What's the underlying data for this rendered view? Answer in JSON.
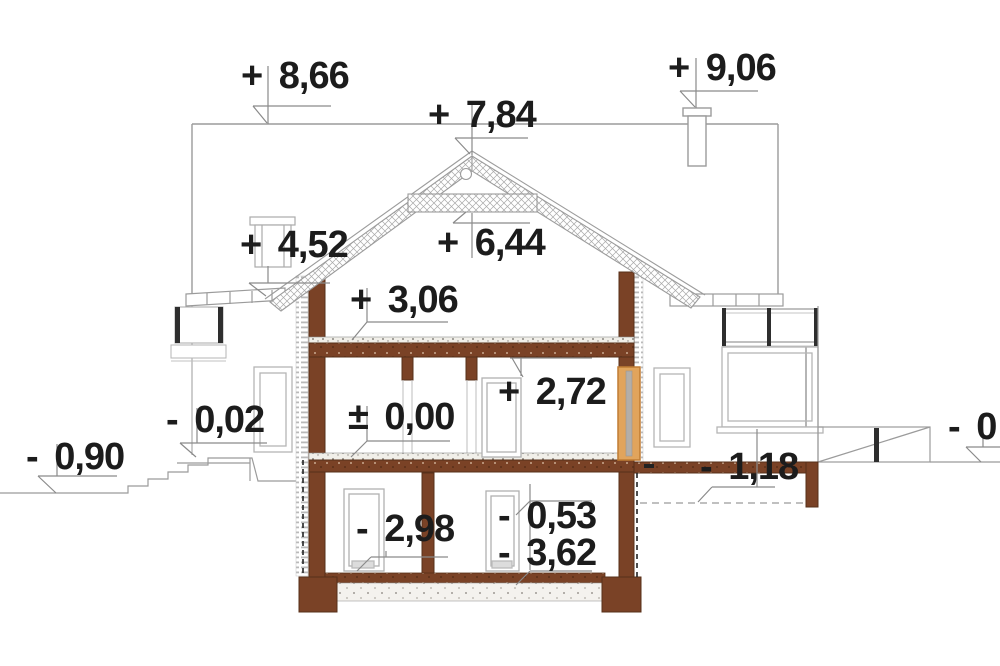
{
  "drawing": {
    "kind": "house cross-section with elevation level marks",
    "unit_style": "decimal comma metres"
  },
  "levels": {
    "chimney_top": "+ 9,06",
    "rear_ridge": "+ 8,66",
    "main_ridge": "+ 7,84",
    "collar_beam": "+ 6,44",
    "side_eave": "+ 4,52",
    "attic_floor": "+ 3,06",
    "ceiling_height": "+ 2,72",
    "ground_floor": "± 0,00",
    "entry_landing": "- 0,02",
    "grade_left": "- 0,90",
    "terrace_base": "- 1,18",
    "basement_floor": "- 2,98",
    "right_upper": "- 0,53",
    "right_lower": "- 3,62",
    "grade_right_partial": "- 0"
  },
  "colors": {
    "cut_wall": "#7a4226",
    "cut_wall_edge": "#57301a",
    "timber_joinery": "#e1a45c",
    "drawing_line": "#9b9b9b",
    "dark_frame": "#2e2e2e",
    "text": "#1c1c1c"
  }
}
